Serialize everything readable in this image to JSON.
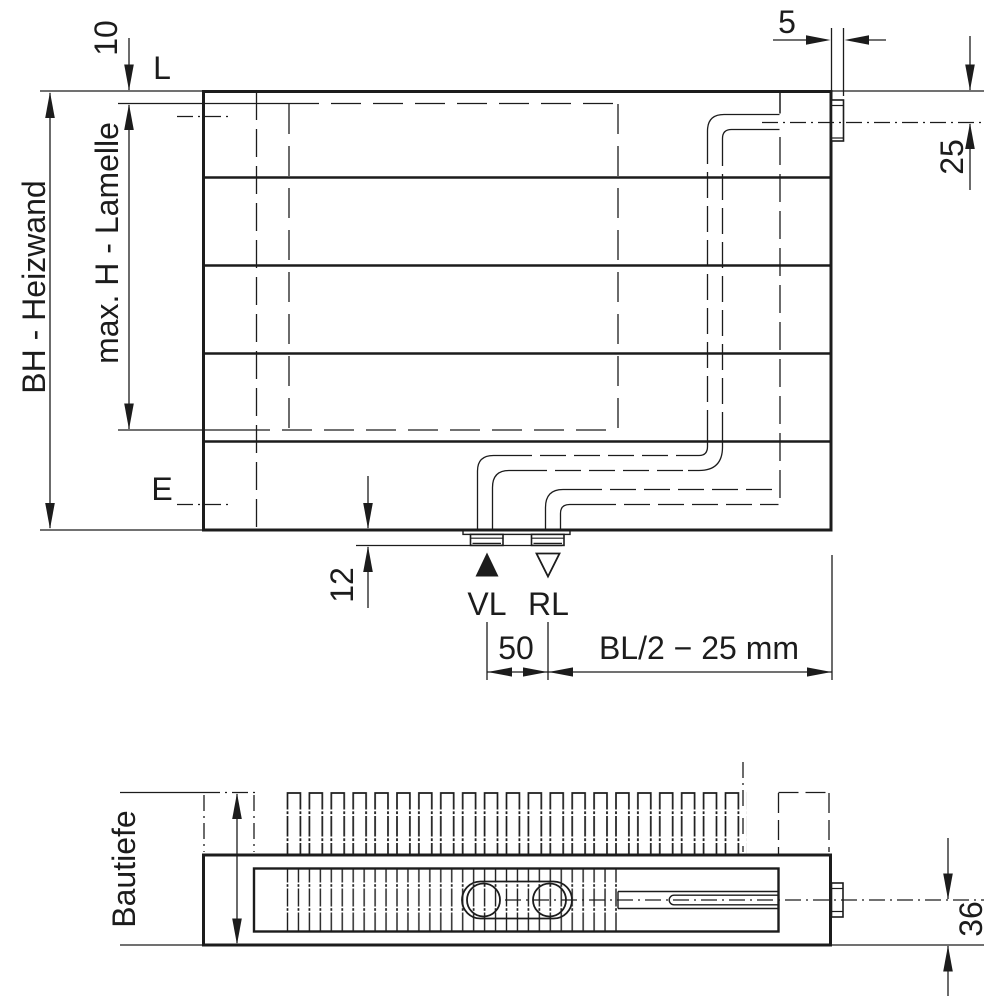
{
  "style": {
    "line_color": "#1c1c1c",
    "background": "#ffffff"
  },
  "front_view": {
    "labels": {
      "height_overall": "BH - Heizwand",
      "height_fins_max": "max. H - Lamelle",
      "top_line": "L",
      "embed_line": "E",
      "supply": "VL",
      "return": "RL"
    },
    "dimensions": {
      "fin_top_offset": "10",
      "connector_width": "5",
      "side_port_axis_offset": "25",
      "bottom_stub_length": "12",
      "port_spacing": "50",
      "port_position_formula": "BL/2 − 25 mm"
    }
  },
  "bottom_view": {
    "labels": {
      "depth": "Bautiefe"
    },
    "dimensions": {
      "port_axis_to_back": "36"
    }
  }
}
